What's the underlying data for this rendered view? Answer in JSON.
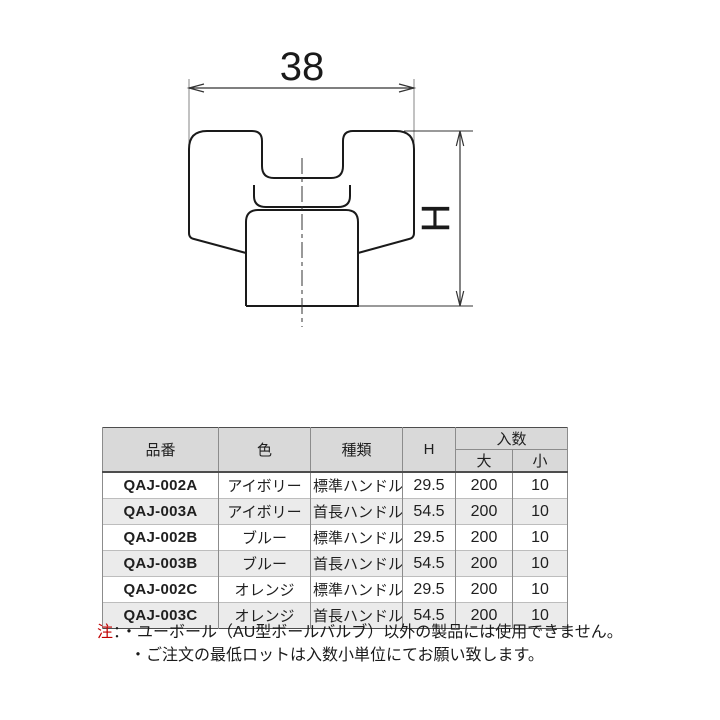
{
  "drawing": {
    "width_label": "38",
    "height_label": "H"
  },
  "table": {
    "headers": {
      "part_no": "品番",
      "color": "色",
      "type": "種類",
      "h": "H",
      "quantity": "入数",
      "large": "大",
      "small": "小"
    },
    "rows": [
      {
        "part_no": "QAJ-002A",
        "color": "アイボリー",
        "type": "標準ハンドル",
        "h": "29.5",
        "large": "200",
        "small": "10"
      },
      {
        "part_no": "QAJ-003A",
        "color": "アイボリー",
        "type": "首長ハンドル",
        "h": "54.5",
        "large": "200",
        "small": "10"
      },
      {
        "part_no": "QAJ-002B",
        "color": "ブルー",
        "type": "標準ハンドル",
        "h": "29.5",
        "large": "200",
        "small": "10"
      },
      {
        "part_no": "QAJ-003B",
        "color": "ブルー",
        "type": "首長ハンドル",
        "h": "54.5",
        "large": "200",
        "small": "10"
      },
      {
        "part_no": "QAJ-002C",
        "color": "オレンジ",
        "type": "標準ハンドル",
        "h": "29.5",
        "large": "200",
        "small": "10"
      },
      {
        "part_no": "QAJ-003C",
        "color": "オレンジ",
        "type": "首長ハンドル",
        "h": "54.5",
        "large": "200",
        "small": "10"
      }
    ]
  },
  "notes": {
    "label": "注",
    "colon": "：",
    "items": [
      "・ユーボール（AU型ボールバルブ）以外の製品には使用できません。",
      "・ご注文の最低ロットは入数小単位にてお願い致します。"
    ]
  },
  "colors": {
    "note_label": "#c00000",
    "header_bg": "#d9d9d9",
    "row_alt_bg": "#ebebeb",
    "outline": "#1a1a1a"
  }
}
